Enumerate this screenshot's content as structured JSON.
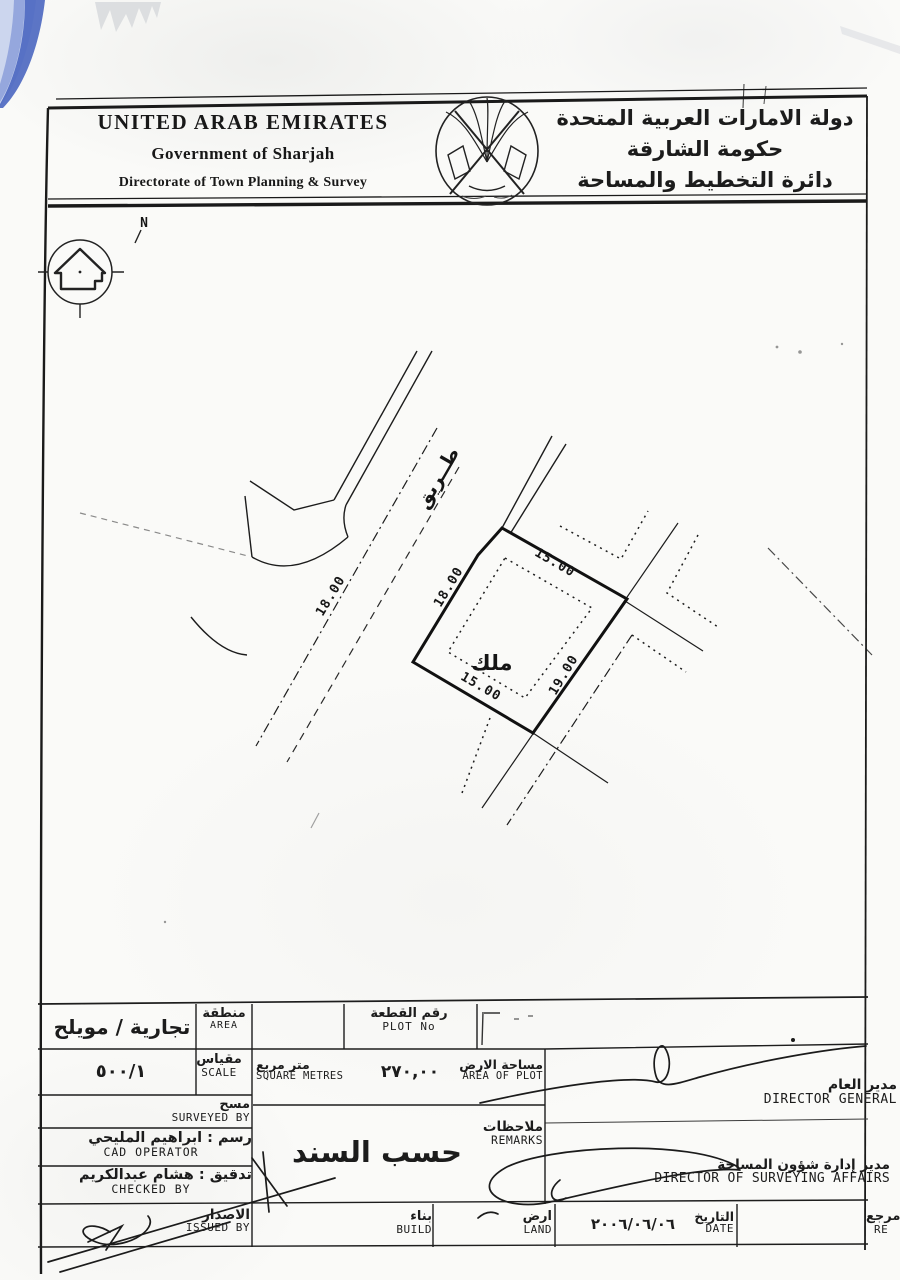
{
  "colors": {
    "ink": "#1c1c1c",
    "blue_artifact": "#4a66c0",
    "paper": "#fafaf8"
  },
  "header": {
    "en_line1": "UNITED ARAB EMIRATES",
    "en_line2": "Government of Sharjah",
    "en_line3": "Directorate of Town Planning &  Survey",
    "ar_line1": "دولة الامارات العربية المتحدة",
    "ar_line2": "حكومة الشارقة",
    "ar_line3": "دائرة التخطيط والمساحة"
  },
  "compass": {
    "label": "N"
  },
  "drawing": {
    "road_label": "طــريق",
    "road_width": "18.00",
    "dim_top": "15.00",
    "dim_left": "18.00",
    "dim_right": "19.00",
    "dim_bottom": "15.00",
    "plot_label": "ملك"
  },
  "table": {
    "area": {
      "label_ar": "منطقة",
      "label_en": "AREA",
      "value": "تجارية / مويلح"
    },
    "plot_no": {
      "label_ar": "رقم القطعة",
      "label_en": "PLOT No",
      "value": ""
    },
    "scale": {
      "label_ar": "مقياس",
      "label_en": "SCALE",
      "value": "٥٠٠/١"
    },
    "square_metres": {
      "label_ar": "متر مربع",
      "label_en": "SQUARE METRES"
    },
    "area_of_plot": {
      "label_ar": "مساحة الارض",
      "label_en": "AREA OF PLOT",
      "value": "٢٧٠,٠٠"
    },
    "surveyed_by": {
      "label_ar": "مسح",
      "label_en": "SURVEYED BY",
      "value": ""
    },
    "cad_operator": {
      "label_ar": "رسم : ابراهيم المليحي",
      "label_en": "CAD OPERATOR"
    },
    "checked_by": {
      "label_ar": "تدقيق : هشام عبدالكريم",
      "label_en": "CHECKED BY"
    },
    "issued_by": {
      "label_ar": "الاصدار",
      "label_en": "ISSUED BY",
      "value": ""
    },
    "remarks": {
      "label_ar": "ملاحظات",
      "label_en": "REMARKS",
      "value": "حسب السند"
    },
    "director_general": {
      "label_ar": "مدير العام",
      "label_en": "DIRECTOR GENERAL"
    },
    "director_surveying": {
      "label_ar": "مدير إدارة شؤون المساحة",
      "label_en": "DIRECTOR OF SURVEYING AFFAIRS"
    },
    "build": {
      "label_ar": "بناء",
      "label_en": "BUILD",
      "value": ""
    },
    "land": {
      "label_ar": "ارض",
      "label_en": "LAND",
      "value": ""
    },
    "date": {
      "label_ar": "التاريخ",
      "label_en": "DATE",
      "value": "٢٠٠٦/٠٦/٠٦"
    },
    "reference": {
      "label_ar": "مرجع",
      "label_en": "RE",
      "value": ""
    }
  }
}
